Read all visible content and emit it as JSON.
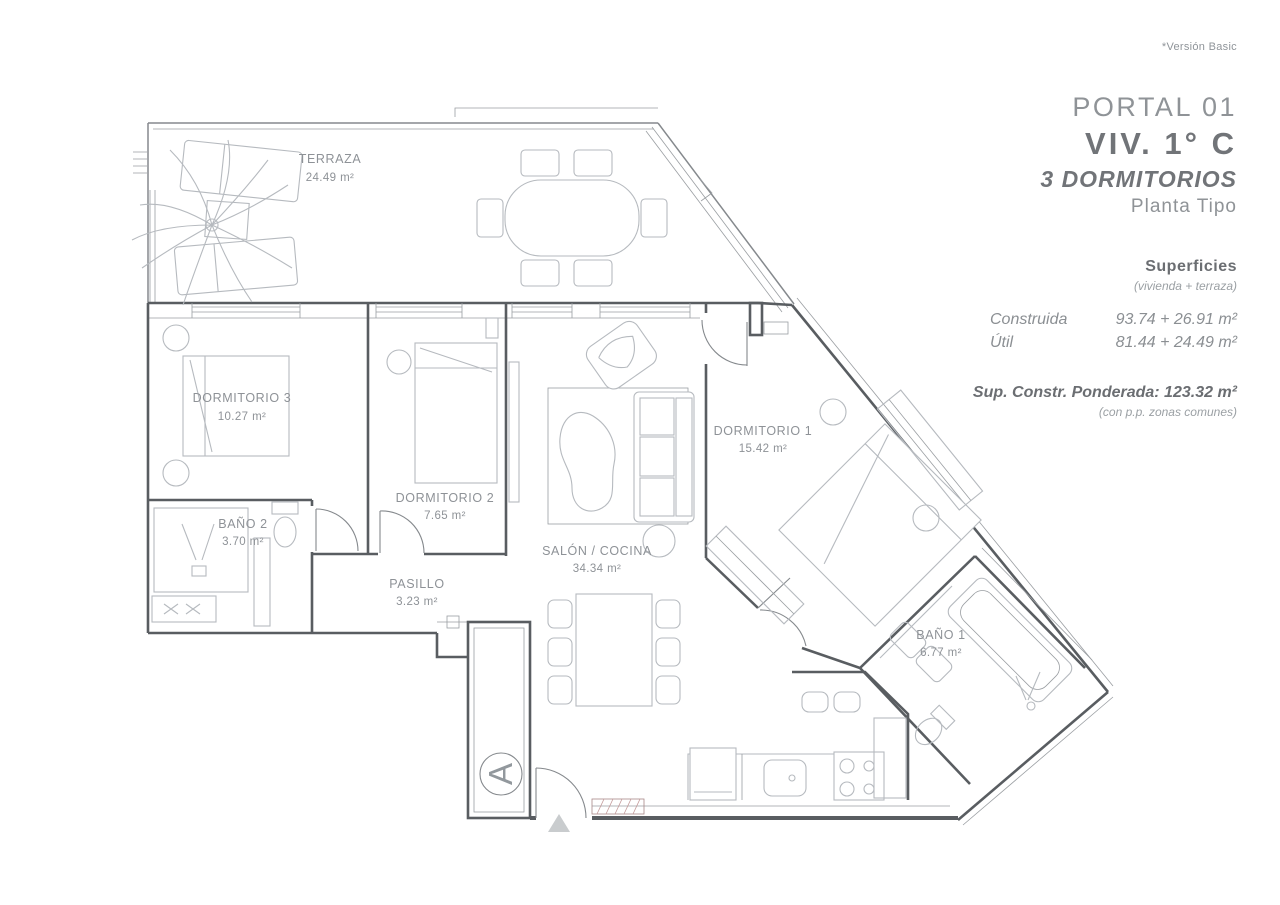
{
  "page": {
    "version_note": "*Versión Basic"
  },
  "title_block": {
    "portal": "PORTAL 01",
    "unit": "VIV. 1° C",
    "bedrooms": "3 DORMITORIOS",
    "plan_type": "Planta Tipo",
    "surfaces_heading": "Superficies",
    "surfaces_subheading": "(vivienda + terraza)",
    "rows": [
      {
        "label": "Construida",
        "value": "93.74 + 26.91 m²"
      },
      {
        "label": "Útil",
        "value": "81.44 + 24.49 m²"
      }
    ],
    "weighted_area": "Sup. Constr. Ponderada: 123.32 m²",
    "weighted_area_note": "(con p.p. zonas comunes)"
  },
  "floor_plan": {
    "core_label": "A",
    "rooms": [
      {
        "name": "TERRAZA",
        "area": "24.49 m²"
      },
      {
        "name": "DORMITORIO 3",
        "area": "10.27 m²"
      },
      {
        "name": "BAÑO 2",
        "area": "3.70 m²"
      },
      {
        "name": "DORMITORIO 2",
        "area": "7.65 m²"
      },
      {
        "name": "PASILLO",
        "area": "3.23 m²"
      },
      {
        "name": "SALÓN / COCINA",
        "area": "34.34 m²"
      },
      {
        "name": "DORMITORIO 1",
        "area": "15.42 m²"
      },
      {
        "name": "BAÑO 1",
        "area": "6.77 m²"
      }
    ],
    "colors": {
      "wall": "#595d61",
      "furniture": "#b6babf",
      "label": "#8e9297",
      "mat_accent": "#c49a9a"
    }
  }
}
